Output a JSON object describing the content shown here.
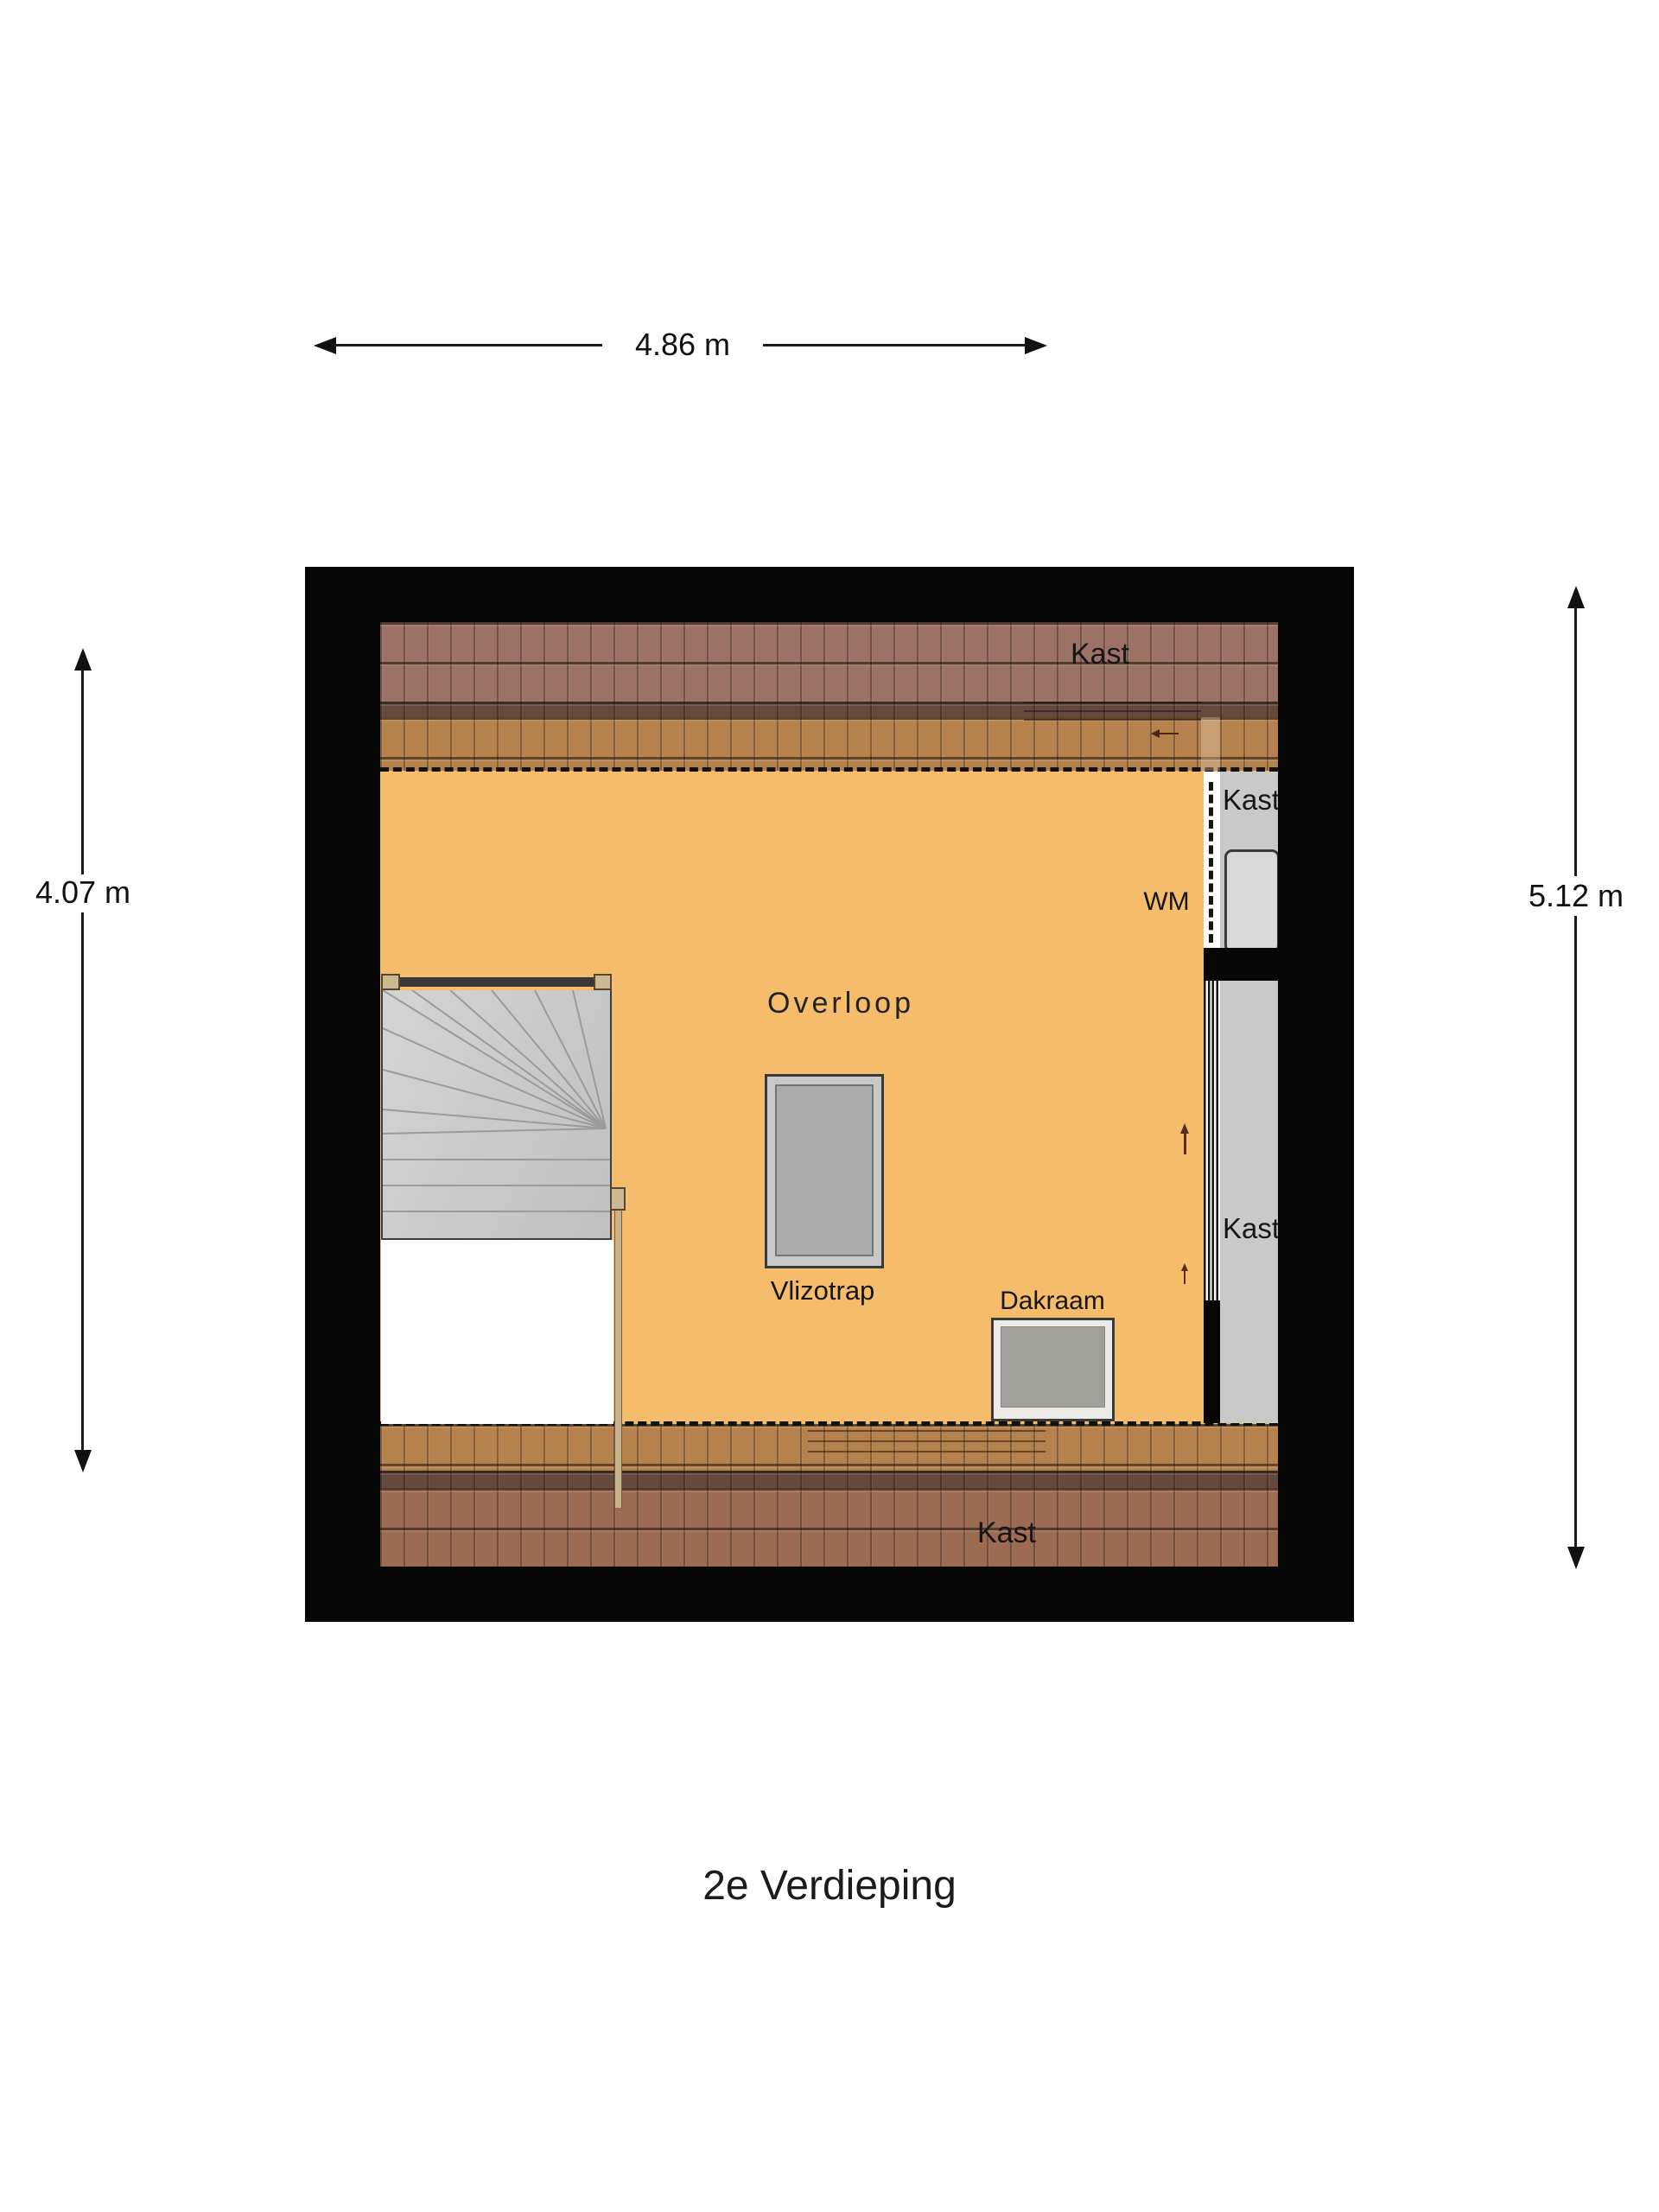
{
  "title": "2e Verdieping",
  "dimensions": {
    "width_top": "4.86 m",
    "height_left": "4.07 m",
    "height_right": "5.12 m"
  },
  "room": {
    "name": "Overloop"
  },
  "features": {
    "vlizotrap": "Vlizotrap",
    "dakraam": "Dakraam",
    "wm": "WM"
  },
  "closets": {
    "top": "Kast",
    "upper_right": "Kast",
    "lower_right": "Kast",
    "bottom": "Kast"
  },
  "colors": {
    "floor": "#f5bc6c",
    "wall": "#070707",
    "roof_dark": "#9b7265",
    "roof_light": "#b5824e",
    "roof_stripe": "#64493c",
    "stair_gray": "#cbcbcb",
    "closet_gray": "#c9c9c9",
    "beige": "#cdb892"
  }
}
